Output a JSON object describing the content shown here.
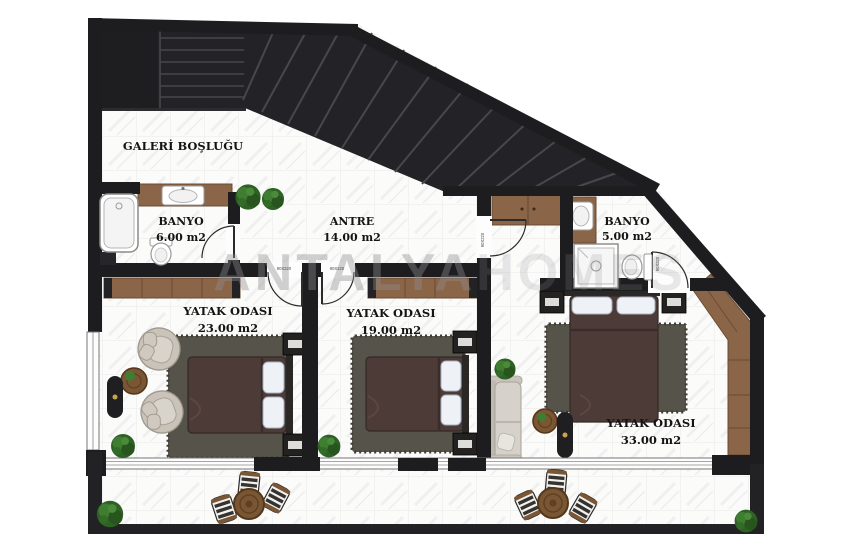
{
  "plan": {
    "watermark": {
      "part1": "ANTALYA",
      "part2": "HOMES"
    },
    "door_size_label": "90X220",
    "rooms": {
      "galeri": {
        "name": "GALERİ BOŞLUĞU",
        "area": ""
      },
      "banyo_left": {
        "name": "BANYO",
        "area": "6.00 m2"
      },
      "antre": {
        "name": "ANTRE",
        "area": "14.00 m2"
      },
      "banyo_right": {
        "name": "BANYO",
        "area": "5.00 m2"
      },
      "bedroom_left": {
        "name": "YATAK ODASI",
        "area": "23.00 m2"
      },
      "bedroom_middle": {
        "name": "YATAK ODASI",
        "area": "19.00 m2"
      },
      "bedroom_right": {
        "name": "YATAK ODASI",
        "area": "33.00 m2"
      }
    },
    "colors": {
      "wall": "#1d1d20",
      "stair_dark": "#232327",
      "wood": "#8a6548",
      "floor": "#fafafa",
      "rug": "#56534a",
      "duvet": "#4d3b38",
      "plant": "#35702b",
      "label_text": "#141414",
      "watermark_gray": "#8f8f8f"
    }
  }
}
